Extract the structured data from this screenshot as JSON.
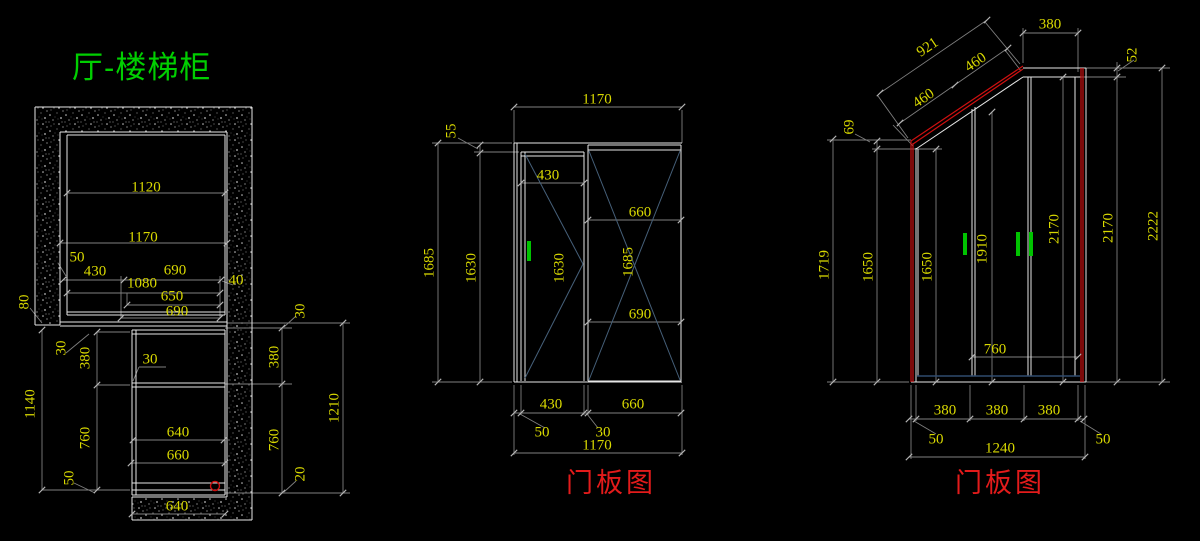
{
  "app": {
    "type": "cad-drawing-viewer",
    "background": "#000000"
  },
  "title": {
    "text": "厅-楼梯柜",
    "color": "#00cf00"
  },
  "colors": {
    "dim_text": "#d9d900",
    "object_line": "#e6e6e6",
    "dim_line": "#7f7f7f",
    "tick": "#b5b5b5",
    "red_line": "#cf1010",
    "red_label": "#e31b1b",
    "handle_green": "#00c300",
    "cross_blue": "#46607a",
    "kick_blue": "#2f4a6e",
    "hatch_dot": "#c8c8c8",
    "title_green": "#00cf00"
  },
  "views": {
    "plan": {
      "label": "厅-楼梯柜",
      "dims": [
        {
          "t": "1120",
          "x": 146,
          "y": 188,
          "r": 0
        },
        {
          "t": "1170",
          "x": 143,
          "y": 238,
          "r": 0
        },
        {
          "t": "50",
          "x": 77,
          "y": 258,
          "r": 0
        },
        {
          "t": "430",
          "x": 95,
          "y": 272,
          "r": 0
        },
        {
          "t": "690",
          "x": 175,
          "y": 271,
          "r": 0
        },
        {
          "t": "1080",
          "x": 142,
          "y": 284,
          "r": 0
        },
        {
          "t": "40",
          "x": 236,
          "y": 281,
          "r": 0
        },
        {
          "t": "650",
          "x": 172,
          "y": 297,
          "r": 0
        },
        {
          "t": "690",
          "x": 177,
          "y": 312,
          "r": 0
        },
        {
          "t": "80",
          "x": 25,
          "y": 302,
          "r": -90
        },
        {
          "t": "30",
          "x": 62,
          "y": 348,
          "r": -90
        },
        {
          "t": "380",
          "x": 86,
          "y": 358,
          "r": -90
        },
        {
          "t": "760",
          "x": 86,
          "y": 438,
          "r": -90
        },
        {
          "t": "50",
          "x": 70,
          "y": 478,
          "r": -90
        },
        {
          "t": "1140",
          "x": 31,
          "y": 404,
          "r": -90
        },
        {
          "t": "30",
          "x": 150,
          "y": 360,
          "r": 0
        },
        {
          "t": "640",
          "x": 178,
          "y": 433,
          "r": 0
        },
        {
          "t": "660",
          "x": 178,
          "y": 456,
          "r": 0
        },
        {
          "t": "640",
          "x": 177,
          "y": 507,
          "r": 0
        },
        {
          "t": "30",
          "x": 301,
          "y": 311,
          "r": -90
        },
        {
          "t": "380",
          "x": 275,
          "y": 357,
          "r": -90
        },
        {
          "t": "760",
          "x": 275,
          "y": 440,
          "r": -90
        },
        {
          "t": "20",
          "x": 301,
          "y": 474,
          "r": -90
        },
        {
          "t": "1210",
          "x": 335,
          "y": 408,
          "r": -90
        }
      ]
    },
    "middle_doors": {
      "caption": "门板图",
      "dims": [
        {
          "t": "1170",
          "x": 597,
          "y": 100,
          "r": 0
        },
        {
          "t": "55",
          "x": 452,
          "y": 131,
          "r": -90
        },
        {
          "t": "1685",
          "x": 430,
          "y": 263,
          "r": -90
        },
        {
          "t": "1630",
          "x": 472,
          "y": 268,
          "r": -90
        },
        {
          "t": "430",
          "x": 548,
          "y": 176,
          "r": 0
        },
        {
          "t": "660",
          "x": 640,
          "y": 213,
          "r": 0
        },
        {
          "t": "1685",
          "x": 629,
          "y": 262,
          "r": -90
        },
        {
          "t": "1630",
          "x": 560,
          "y": 268,
          "r": -90
        },
        {
          "t": "690",
          "x": 640,
          "y": 315,
          "r": 0
        },
        {
          "t": "430",
          "x": 551,
          "y": 405,
          "r": 0
        },
        {
          "t": "660",
          "x": 633,
          "y": 405,
          "r": 0
        },
        {
          "t": "50",
          "x": 542,
          "y": 433,
          "r": 0
        },
        {
          "t": "30",
          "x": 603,
          "y": 433,
          "r": 0
        },
        {
          "t": "1170",
          "x": 597,
          "y": 446,
          "r": 0
        }
      ]
    },
    "right_doors": {
      "caption": "门板图",
      "dims": [
        {
          "t": "921",
          "x": 928,
          "y": 48,
          "r": -34
        },
        {
          "t": "460",
          "x": 924,
          "y": 99,
          "r": -34
        },
        {
          "t": "460",
          "x": 976,
          "y": 63,
          "r": -34
        },
        {
          "t": "380",
          "x": 1050,
          "y": 25,
          "r": 0
        },
        {
          "t": "52",
          "x": 1133,
          "y": 55,
          "r": -90
        },
        {
          "t": "69",
          "x": 850,
          "y": 127,
          "r": -90
        },
        {
          "t": "1719",
          "x": 825,
          "y": 265,
          "r": -90
        },
        {
          "t": "1650",
          "x": 869,
          "y": 267,
          "r": -90
        },
        {
          "t": "1650",
          "x": 928,
          "y": 267,
          "r": -90
        },
        {
          "t": "1910",
          "x": 983,
          "y": 249,
          "r": -90
        },
        {
          "t": "2170",
          "x": 1055,
          "y": 229,
          "r": -90
        },
        {
          "t": "2170",
          "x": 1109,
          "y": 228,
          "r": -90
        },
        {
          "t": "2222",
          "x": 1154,
          "y": 226,
          "r": -90
        },
        {
          "t": "760",
          "x": 995,
          "y": 350,
          "r": 0
        },
        {
          "t": "380",
          "x": 945,
          "y": 411,
          "r": 0
        },
        {
          "t": "380",
          "x": 997,
          "y": 411,
          "r": 0
        },
        {
          "t": "380",
          "x": 1049,
          "y": 411,
          "r": 0
        },
        {
          "t": "50",
          "x": 936,
          "y": 440,
          "r": 0
        },
        {
          "t": "50",
          "x": 1103,
          "y": 440,
          "r": 0
        },
        {
          "t": "1240",
          "x": 1000,
          "y": 449,
          "r": 0
        }
      ]
    }
  }
}
